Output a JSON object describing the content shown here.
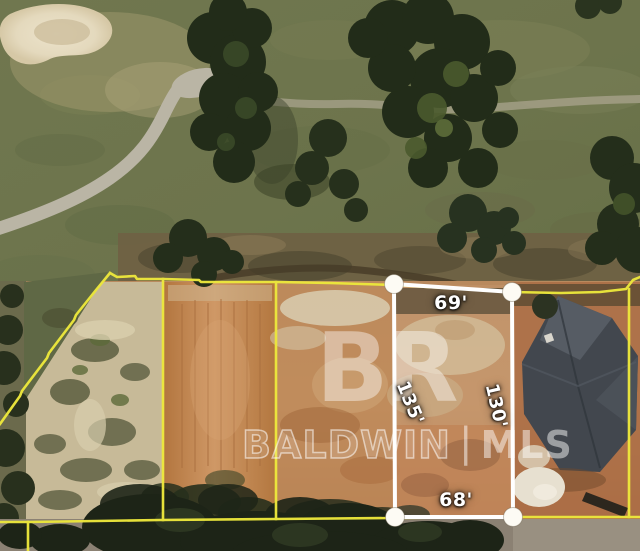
{
  "scene": {
    "kind": "aerial-parcel-photo"
  },
  "watermark": {
    "logo": "BR",
    "brand_left": "BALDWIN",
    "separator": "|",
    "brand_right": "MLS"
  },
  "lot_dimensions": {
    "top": "69'",
    "left": "135'",
    "right": "130'",
    "bottom": "68'"
  },
  "colors": {
    "parcel_line": "#ece73c",
    "lot_outline": "#ffffff",
    "handle_fill": "#fdfbf4",
    "dimension_text": "#ffffff",
    "watermark_text": "rgba(255,255,255,0.45)",
    "grass": "#6f744d",
    "dirt": "#bc8a5c",
    "sand": "#e7dec6",
    "trees": "#222c19",
    "roof": "#42474e"
  }
}
